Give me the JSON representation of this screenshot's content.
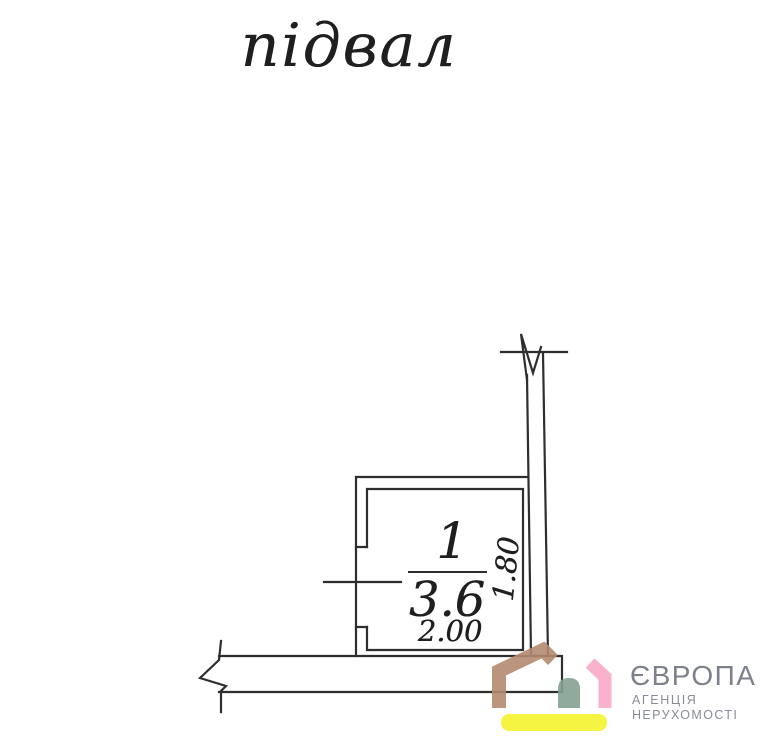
{
  "title": "підвал",
  "plan": {
    "room": {
      "number": "1",
      "area": "3.6",
      "width_dim": "2.00",
      "height_dim": "1.80"
    }
  },
  "logo": {
    "brand": "ЄВРОПА",
    "tagline_line1": "АГЕНЦІЯ",
    "tagline_line2": "НЕРУХОМОСТІ"
  },
  "colors": {
    "plan_line": "#2e2e2e",
    "plan_text": "#1f1f1f",
    "brand_text": "#7d818c",
    "tagline_text": "#888c96",
    "logo_brown": "#b48a70",
    "logo_green": "#85a191",
    "logo_pink": "#f9a9c9",
    "logo_yellow": "#f5f32e"
  }
}
